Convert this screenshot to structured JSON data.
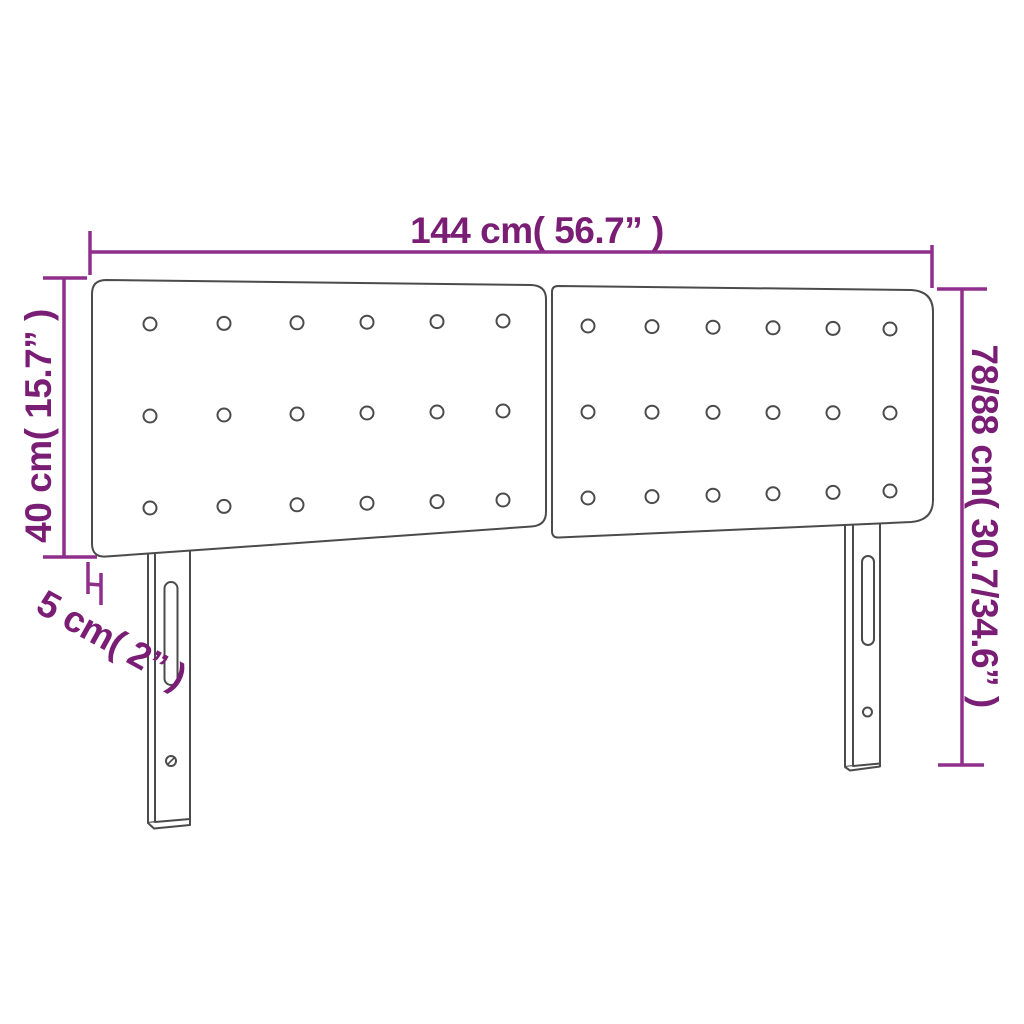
{
  "diagram": {
    "kind": "product-dimension-diagram",
    "subject": "upholstered headboard, two tufted panels with two slotted legs",
    "background_color": "#ffffff",
    "outline_color": "#4b4b4b",
    "dimension_line_color": "#8F2E8B",
    "dimension_text_color": "#7A1E75",
    "labels": {
      "width": "144 cm( 56.7” )",
      "panel_height": "40 cm( 15.7” )",
      "total_height": "78/88 cm( 30.7/34.6” )",
      "depth": "5 cm( 2” )"
    },
    "product": {
      "panel_count": 2,
      "button_rows_per_panel": 3,
      "buttons_per_row": 6,
      "leg_count": 2
    }
  }
}
